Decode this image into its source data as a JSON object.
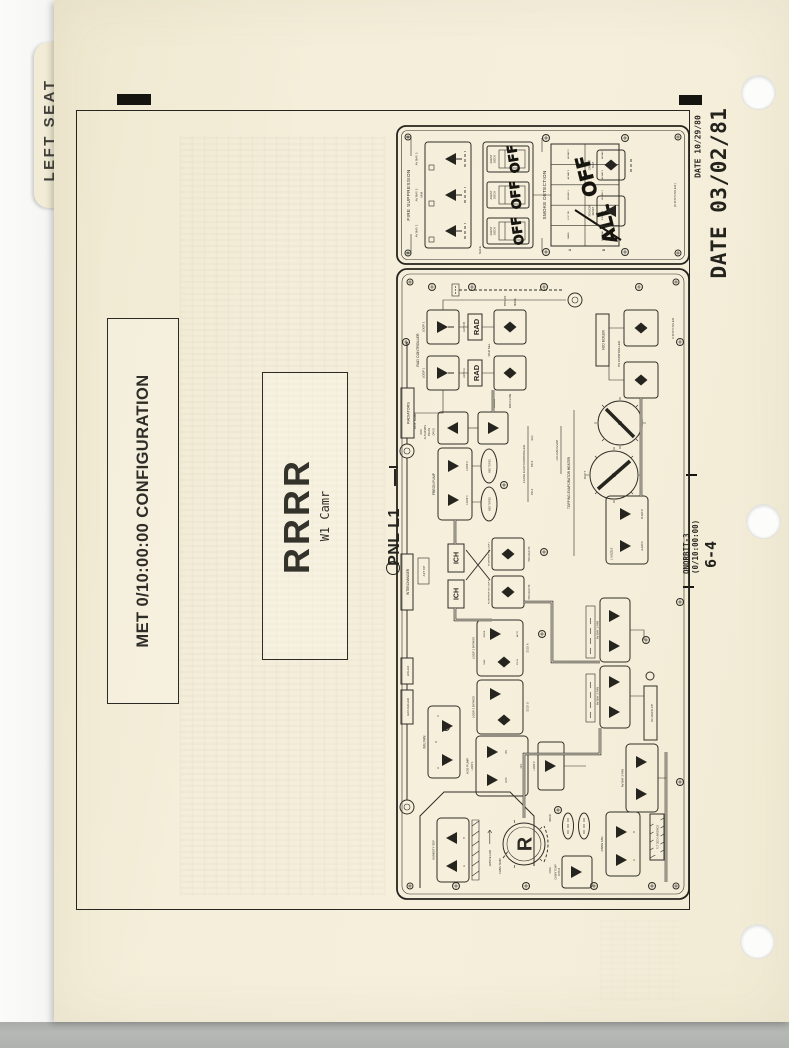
{
  "colors": {
    "paper": "#f3edd9",
    "ink": "#2c2a24",
    "handwriting": "#15140f",
    "scanner_bg": "#eff1ed",
    "bottom_strip": "#b3b5b2"
  },
  "page": {
    "tab_label": "LEFT SEAT",
    "date_stamp_small": "DATE 10/29/80",
    "date_stamp_large": "DATE 03/02/81",
    "met_label": "MET 0/10:00:00 CONFIGURATION",
    "title": "RRRR",
    "subtitle": "W1 Camr",
    "panel_ref": "PNL L1",
    "footer_line1": "ONORBIT-3",
    "footer_line2": "(0/10:00:00)",
    "footer_page": "6-4"
  },
  "annotations": {
    "off1": "OFF",
    "off2": "OFF",
    "off3": "OFF",
    "all": "ALL",
    "off_big": "OFF"
  },
  "top_panel": {
    "fire": {
      "header": "FIRE SUPPRESSION",
      "bay1": "AV BAY 1",
      "bay2": "AV BAY 2",
      "bay3": "AV BAY 3",
      "arm": "ARM",
      "safe": "SAFE",
      "agent1a": "AGENT",
      "agent1b": "DISCH",
      "agent2a": "AGENT",
      "agent2b": "DISCH",
      "agent3a": "AGENT",
      "agent3b": "DISCH"
    },
    "smoke": {
      "header": "SMOKE DETECTION",
      "row_a": "A",
      "row_b": "B",
      "a1": "CABIN",
      "a2": "L FLT DK",
      "a3": "AV BAY 1",
      "a4": "AV BAY 2",
      "a5": "AV BAY 3",
      "b1": "PAYLOAD",
      "b2": "R FLT DK",
      "b3": "AV BAY 1",
      "b4": "AV BAY 2",
      "b5": "AV BAY 3",
      "circuit1": "CIRCUIT",
      "circuit2": "TEST",
      "sensor1": "SENSOR",
      "sensor2": "RESET"
    },
    "continued": "(CONTINUED)"
  },
  "main_panel": {
    "radiators": "RADIATORS",
    "lcg": "LCG HX",
    "chiller": "H2O CHILLER",
    "interchanger": "INTERCHANGER",
    "aft_cp": "AFT CP",
    "rad_title": "RAD CONTROLLER",
    "rad_loop1": "LOOP 1",
    "rad_loop2": "LOOP 2",
    "auto_a": "AUTO A",
    "auto_b": "AUTO B",
    "rad_tb1": "RAD",
    "rad_tb2": "RAD",
    "rad_sel": "RAD SEL",
    "rad_flow": "RAD FLOW",
    "bypass_d": "BYPASS",
    "mode": "MODE",
    "out_temp": "OUT TEMP",
    "alt1": "H2O",
    "alt2": "ALTERNATE",
    "alt3": "PRESS",
    "open": "OPEN",
    "close": "CLOSE",
    "boiler": "H2O BOILER",
    "hx_ctl": "HX CONTROLLER",
    "freon": "FREON PUMP",
    "f_loop1": "LOOP 1",
    "f_loop2": "LOOP 2",
    "oval1": "H2O TO FES",
    "oval2": "H2O TO FES",
    "fec": "FLASH EVAP CONTROLLER",
    "pri_a": "PRI A",
    "pri_b": "PRI B",
    "sec": "SEC",
    "ich1": "ICH",
    "ich2": "ICH",
    "fp1": "FLOW PROP VLV LOOP 1",
    "fp2": "FLOW PROP VLV LOOP 2",
    "pl_hx1": "PAYLOAD HX",
    "pl_hx2": "PAYLOAD HX",
    "topping": "TOPPING EVAPORATOR HEATER",
    "duct": "DUCT",
    "hi_load": "HI LOAD EVAP",
    "noz_l": "L NOZZLE",
    "a_auto": "A AUTO",
    "b_auto": "B AUTO",
    "byp1": "LOOP 1 BYPASS",
    "byp2": "LOOP 2 BYPASS",
    "byp_mode": "MODE",
    "byp_auto": "AUTO",
    "rad_s": "RAD",
    "ich_b": "ICH B",
    "deck_a": "DECK A",
    "deck_b": "DECK B",
    "imu": "IMU FAN",
    "imu_a": "A",
    "imu_b": "B",
    "imu_c": "C",
    "pump": "H2O PUMP",
    "pump_l1": "LOOP 1",
    "pump_l2": "LOOP 2",
    "gpc": "GPC",
    "on": "ON",
    "off": "OFF",
    "fan1": "AV BAY 1 FAN",
    "fan2": "AV BAY 2 FAN",
    "fan3": "AV BAY 3 FAN",
    "av_rack": "AV RACK CP",
    "hum": "HUMIDITY SEP",
    "hum_a": "A",
    "hum_b": "B",
    "waste": "WASTE H2O",
    "cabin_temp": "CABIN TEMP",
    "knob_r": "R",
    "cool": "COOL",
    "warm": "WARM",
    "ctc1": "CABIN TEMP",
    "ctc2": "CNTLR",
    "cabin_fan": "CABIN FAN",
    "cf_a": "A",
    "cf_b": "B",
    "flt_deck": "FLT DECK AVIONICS",
    "continued": "CONTINUED"
  }
}
